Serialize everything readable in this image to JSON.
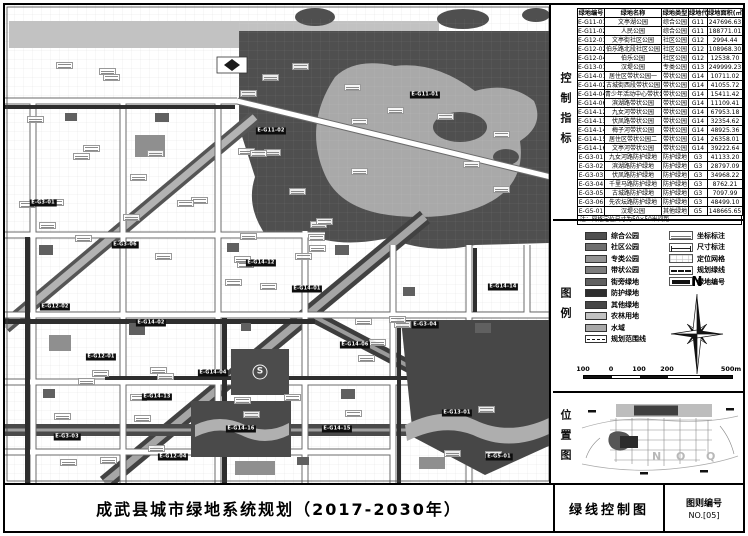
{
  "title": "成武县城市绿地系统规划（2017-2030年）",
  "sheet": {
    "name": "绿线控制图",
    "number_label": "图则编号",
    "number": "NO.[05]"
  },
  "panel_sections": {
    "control": "控制指标",
    "legend": "图例",
    "location": "位置图"
  },
  "table": {
    "headers": [
      "绿地编号",
      "绿地名称",
      "绿地类型",
      "绿地代码",
      "绿地面积(㎡)"
    ],
    "rows": [
      [
        "E-G11-01",
        "文亭湖公园",
        "综合公园",
        "G11",
        "247696.63"
      ],
      [
        "E-G11-02",
        "人民公园",
        "综合公园",
        "G11",
        "188771.01"
      ],
      [
        "E-G12-01",
        "文亭街社区公园",
        "社区公园",
        "G12",
        "2994.44"
      ],
      [
        "E-G12-02",
        "伯乐路北段社区公园",
        "社区公园",
        "G12",
        "108968.30"
      ],
      [
        "E-G12-04",
        "伯乐公园",
        "社区公园",
        "G12",
        "12538.70"
      ],
      [
        "E-G13-01",
        "汉堤公园",
        "专类公园",
        "G13",
        "249999.23"
      ],
      [
        "E-G14-01",
        "居住区带状公园一",
        "带状公园",
        "G14",
        "10711.02"
      ],
      [
        "E-G14-02",
        "古城街西段带状公园",
        "带状公园",
        "G14",
        "41055.72"
      ],
      [
        "E-G14-04",
        "青少年活动中心带状公园",
        "带状公园",
        "G14",
        "15411.42"
      ],
      [
        "E-G14-06",
        "滨湖路带状公园",
        "带状公园",
        "G14",
        "11109.41"
      ],
      [
        "E-G14-12",
        "九女河带状公园",
        "带状公园",
        "G14",
        "67953.18"
      ],
      [
        "E-G14-13",
        "伏凤路带状公园",
        "带状公园",
        "G14",
        "32354.62"
      ],
      [
        "E-G14-14",
        "梅子河带状公园",
        "带状公园",
        "G14",
        "48925.36"
      ],
      [
        "E-G14-15",
        "居住区带状公园二",
        "带状公园",
        "G14",
        "26358.01"
      ],
      [
        "E-G14-16",
        "文亭河带状公园",
        "带状公园",
        "G14",
        "39222.64"
      ],
      [
        "E-G3-01",
        "九女河路防护绿地",
        "防护绿地",
        "G3",
        "41133.20"
      ],
      [
        "E-G3-02",
        "滨湖路防护绿地",
        "防护绿地",
        "G3",
        "28797.09"
      ],
      [
        "E-G3-03",
        "伏凤路防护绿地",
        "防护绿地",
        "G3",
        "34968.22"
      ],
      [
        "E-G3-04",
        "千里马路防护绿地",
        "防护绿地",
        "G3",
        "8762.21"
      ],
      [
        "E-G3-05",
        "古城路防护绿地",
        "防护绿地",
        "G3",
        "7097.99"
      ],
      [
        "E-G3-06",
        "先农坛路防护绿地",
        "防护绿地",
        "G3",
        "48499.10"
      ],
      [
        "E-G5-01",
        "汉堤公园",
        "其他绿地",
        "G5",
        "148665.65"
      ]
    ],
    "note": "注：网格定位尺寸为50×50米间距"
  },
  "legend": {
    "items": [
      {
        "label": "综合公园",
        "swatch": "#4f4f4f"
      },
      {
        "label": "社区公园",
        "swatch": "#6f6f6f"
      },
      {
        "label": "专类公园",
        "swatch": "#939393"
      },
      {
        "label": "带状公园",
        "swatch": "#7d7d7d"
      },
      {
        "label": "街旁绿地",
        "swatch": "#606060"
      },
      {
        "label": "防护绿地",
        "swatch": "#2e2e2e"
      },
      {
        "label": "其他绿地",
        "swatch": "#474747"
      },
      {
        "label": "农林用地",
        "swatch": "#c2c2c2"
      },
      {
        "label": "水域",
        "swatch": "#a9a9a9"
      },
      {
        "label": "规划范围线",
        "swatch": "dash"
      }
    ],
    "symbols": [
      {
        "label": "坐标标注",
        "type": "coord"
      },
      {
        "label": "尺寸标注",
        "type": "dim"
      },
      {
        "label": "定位网格",
        "type": "grid"
      },
      {
        "label": "规划绿线",
        "type": "gline"
      },
      {
        "label": "绿地编号",
        "type": "badge"
      }
    ]
  },
  "north_label": "N",
  "scalebar": {
    "labels": [
      "100",
      "0",
      "100",
      "200",
      "500m"
    ]
  },
  "location_map": {
    "index_letters": [
      "N",
      "O",
      "Q"
    ]
  },
  "map": {
    "stadium_symbol": "S",
    "badges": [
      {
        "code": "E-G11-01",
        "x": 420,
        "y": 90
      },
      {
        "code": "E-G11-02",
        "x": 266,
        "y": 126
      },
      {
        "code": "E-G3-01",
        "x": 38,
        "y": 198
      },
      {
        "code": "E-G3-06",
        "x": 120,
        "y": 240
      },
      {
        "code": "E-G14-12",
        "x": 256,
        "y": 258
      },
      {
        "code": "E-G14-01",
        "x": 302,
        "y": 284
      },
      {
        "code": "E-G14-14",
        "x": 498,
        "y": 282
      },
      {
        "code": "E-G12-02",
        "x": 50,
        "y": 302
      },
      {
        "code": "E-G14-02",
        "x": 146,
        "y": 318
      },
      {
        "code": "E-G3-04",
        "x": 420,
        "y": 320
      },
      {
        "code": "E-G14-06",
        "x": 350,
        "y": 340
      },
      {
        "code": "E-G12-01",
        "x": 96,
        "y": 352
      },
      {
        "code": "E-G14-04",
        "x": 208,
        "y": 368
      },
      {
        "code": "E-G14-13",
        "x": 152,
        "y": 392
      },
      {
        "code": "E-G13-01",
        "x": 452,
        "y": 408
      },
      {
        "code": "E-G14-16",
        "x": 236,
        "y": 424
      },
      {
        "code": "E-G14-15",
        "x": 332,
        "y": 424
      },
      {
        "code": "E-G3-03",
        "x": 62,
        "y": 432
      },
      {
        "code": "E-G12-04",
        "x": 168,
        "y": 452
      },
      {
        "code": "E-G5-01",
        "x": 494,
        "y": 452
      }
    ]
  }
}
